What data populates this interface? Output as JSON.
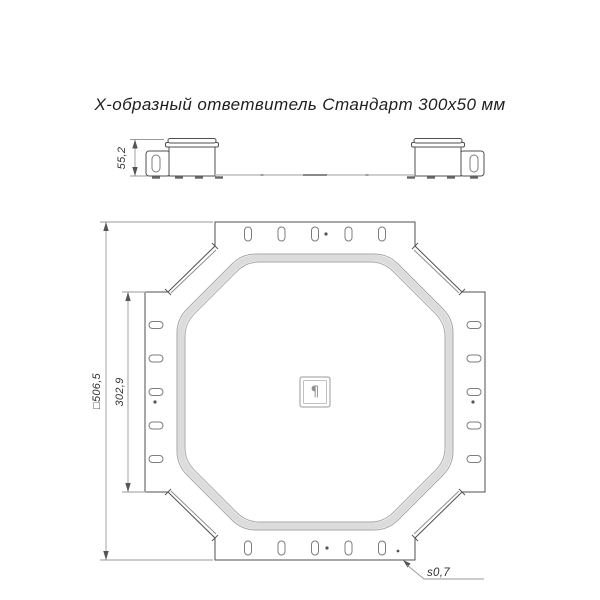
{
  "title": "Х-образный ответвитель Стандарт 300х50 мм",
  "dims": {
    "height": "55,2",
    "overall": "□506,5",
    "branch": "302,9",
    "thickness": "s0,7"
  },
  "logo": {
    "glyph": "¶"
  },
  "colors": {
    "outline": "#4f4f4f",
    "dimension": "#999999",
    "bend_band": "#dcdcdc",
    "title_text": "#1f1f1f",
    "background": "#ffffff"
  }
}
